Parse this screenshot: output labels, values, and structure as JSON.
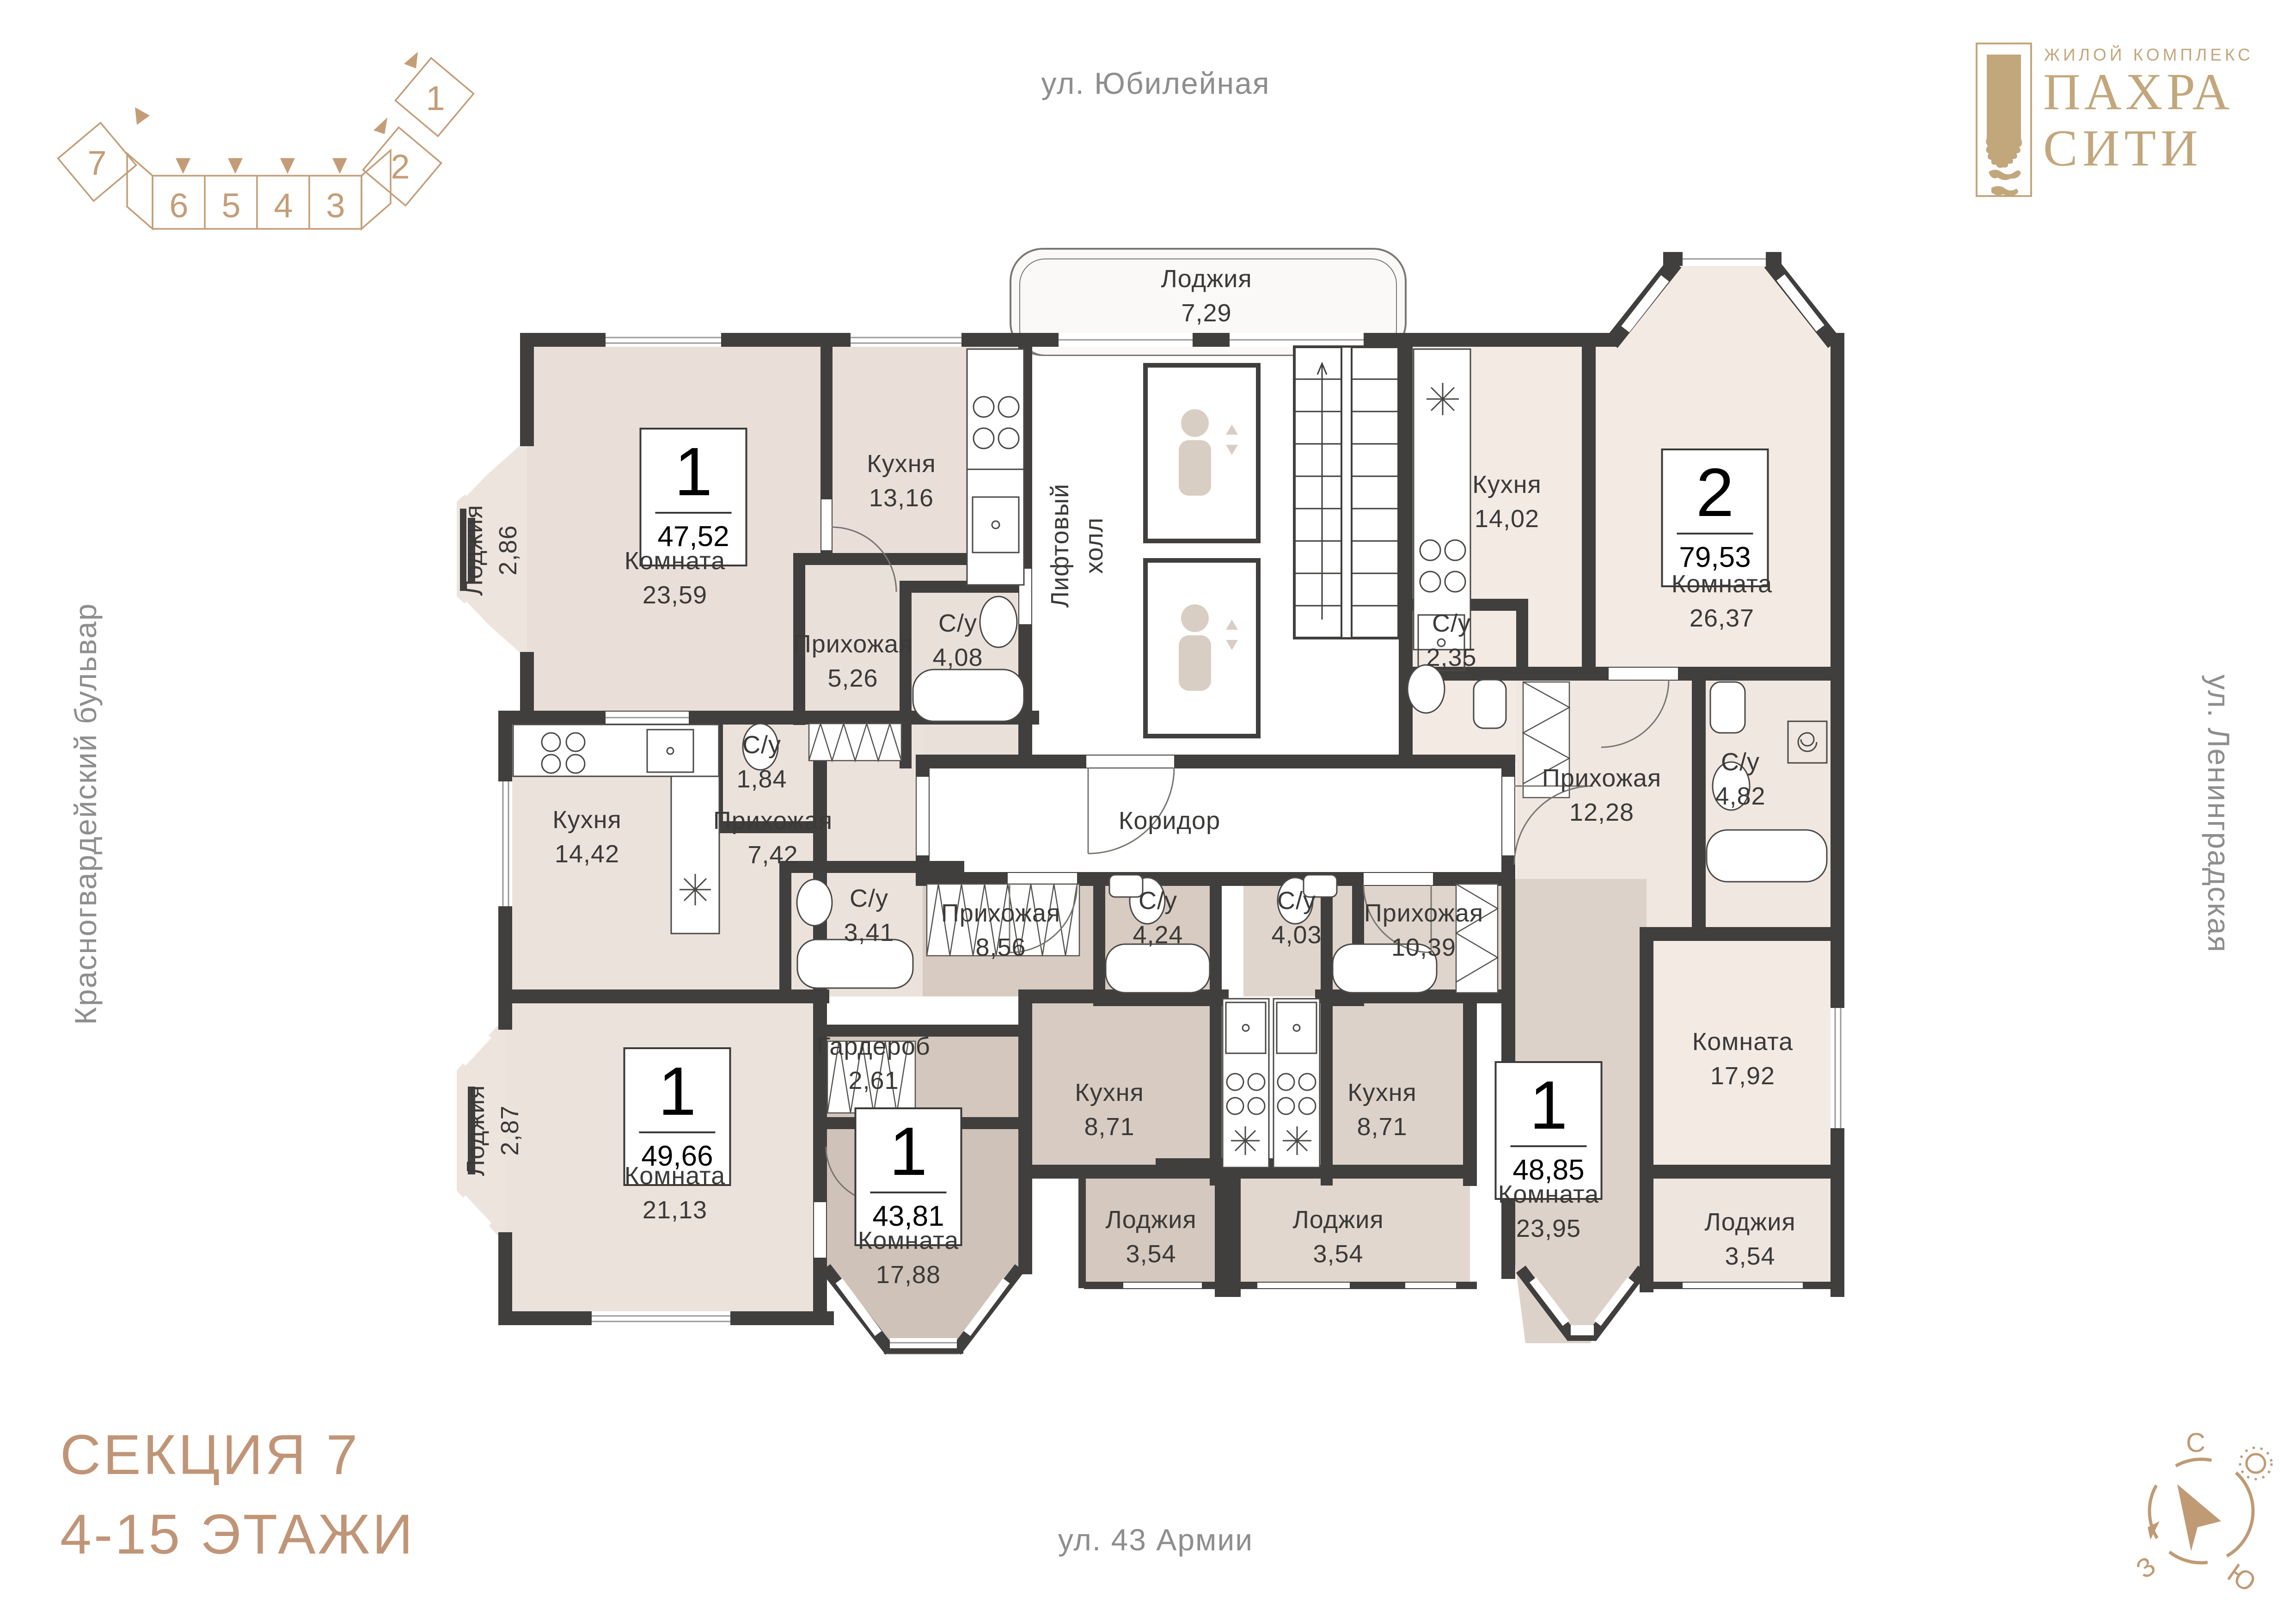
{
  "title": "План этажа — секция 7, 4-15 этажи",
  "streets": {
    "top": "ул. Юбилейная",
    "left": "Красногвардейский бульвар",
    "right": "ул. Ленинградская",
    "bottom": "ул. 43 Армии"
  },
  "logo": {
    "subtitle": "ЖИЛОЙ КОМПЛЕКС",
    "title_line1": "ПАХРА",
    "title_line2": "СИТИ"
  },
  "section_info": {
    "line1": "СЕКЦИЯ 7",
    "line2": "4-15 ЭТАЖИ"
  },
  "section_diagram": {
    "sections": [
      "7",
      "6",
      "5",
      "4",
      "3",
      "2",
      "1"
    ],
    "current": "7"
  },
  "compass": {
    "north": "С",
    "west": "З",
    "south": "Ю"
  },
  "common_areas": {
    "loggia_top": {
      "name": "Лоджия",
      "area": "7,29"
    },
    "lift_hall_line1": "Лифтовый",
    "lift_hall_line2": "холл",
    "corridor": "Коридор"
  },
  "apartments": [
    {
      "rooms_count": "1",
      "total_area": "47,52",
      "rooms": [
        {
          "name": "Комната",
          "area": "23,59"
        },
        {
          "name": "Кухня",
          "area": "13,16"
        },
        {
          "name": "Прихожая",
          "area": "5,26"
        },
        {
          "name": "С/у",
          "area": "4,08"
        },
        {
          "name": "Лоджия",
          "area": "2,86"
        }
      ]
    },
    {
      "rooms_count": "2",
      "total_area": "79,53",
      "rooms": [
        {
          "name": "Кухня",
          "area": "14,02"
        },
        {
          "name": "Комната",
          "area": "26,37"
        },
        {
          "name": "С/у",
          "area": "2,35"
        },
        {
          "name": "Прихожая",
          "area": "12,28"
        },
        {
          "name": "С/у",
          "area": "4,82"
        },
        {
          "name": "Комната",
          "area": "17,92"
        },
        {
          "name": "Лоджия",
          "area": "3,54"
        }
      ]
    },
    {
      "rooms_count": "1",
      "total_area": "49,66",
      "rooms": [
        {
          "name": "Кухня",
          "area": "14,42"
        },
        {
          "name": "С/у",
          "area": "1,84"
        },
        {
          "name": "Прихожая",
          "area": "7,42"
        },
        {
          "name": "С/у",
          "area": "3,41"
        },
        {
          "name": "Комната",
          "area": "21,13"
        },
        {
          "name": "Лоджия",
          "area": "2,87"
        }
      ]
    },
    {
      "rooms_count": "1",
      "total_area": "43,81",
      "rooms": [
        {
          "name": "Прихожая",
          "area": "8,56"
        },
        {
          "name": "С/у",
          "area": "4,24"
        },
        {
          "name": "Гардероб",
          "area": "2,61"
        },
        {
          "name": "Кухня",
          "area": "8,71"
        },
        {
          "name": "Комната",
          "area": "17,88"
        },
        {
          "name": "Лоджия",
          "area": "3,54"
        }
      ]
    },
    {
      "rooms_count": "1",
      "total_area": "48,85",
      "rooms": [
        {
          "name": "Прихожая",
          "area": "10,39"
        },
        {
          "name": "С/у",
          "area": "4,03"
        },
        {
          "name": "Кухня",
          "area": "8,71"
        },
        {
          "name": "Комната",
          "area": "23,95"
        },
        {
          "name": "Лоджия",
          "area": "3,54"
        }
      ]
    }
  ],
  "colors": {
    "accent_gold": "#c09d77",
    "logo_gold": "#c2a77c",
    "wall": "#403f3d",
    "label_text": "#3b3a38",
    "street_text": "#8e8e8e",
    "fill_light_beige": "#e9dfd8",
    "fill_pink_beige": "#f3eae4",
    "fill_taupe": "#d7cbc2",
    "fill_dark_taupe": "#cfc2b8",
    "fill_warm_gray": "#ddd2c9"
  }
}
